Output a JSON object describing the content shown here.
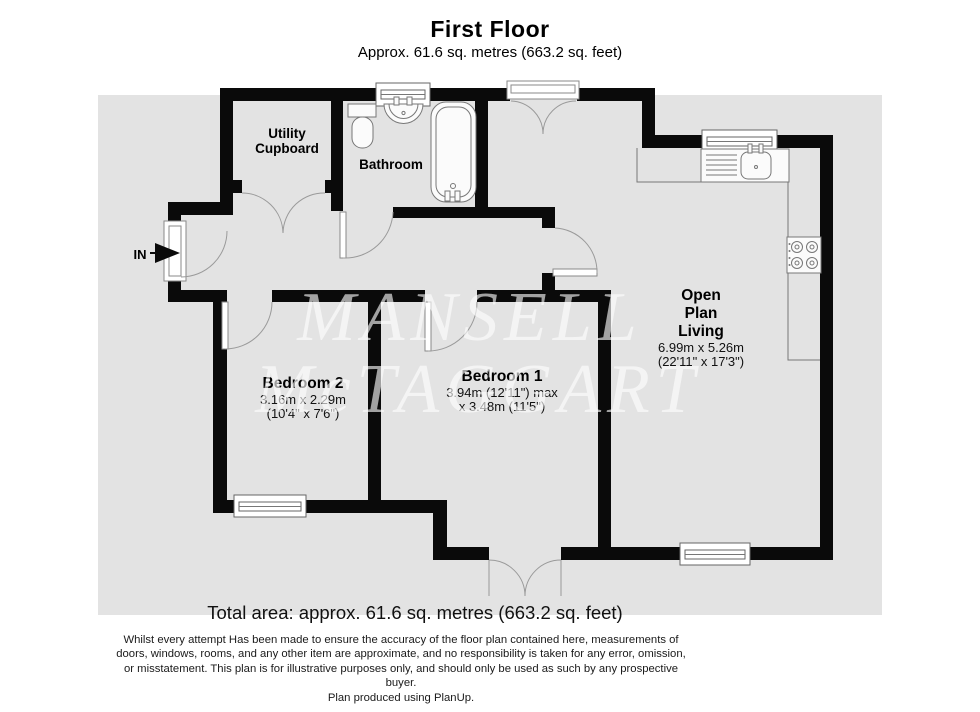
{
  "header": {
    "title": "First Floor",
    "subtitle": "Approx. 61.6 sq. metres (663.2 sq. feet)"
  },
  "rooms": {
    "utility": {
      "name_line1": "Utility",
      "name_line2": "Cupboard"
    },
    "bathroom": {
      "name": "Bathroom"
    },
    "bedroom2": {
      "name": "Bedroom 2",
      "dims_metric": "3.16m x 2.29m",
      "dims_imperial": "(10'4\" x 7'6\")"
    },
    "bedroom1": {
      "name": "Bedroom 1",
      "dims_line1": "3.94m (12'11\") max",
      "dims_line2": "x 3.48m (11'5\")"
    },
    "open_plan_living": {
      "name_line1": "Open",
      "name_line2": "Plan",
      "name_line3": "Living",
      "dims_metric": "6.99m x 5.26m",
      "dims_imperial": "(22'11\" x 17'3\")"
    }
  },
  "entrance": {
    "label": "IN"
  },
  "watermark": {
    "line1": "MANSELL",
    "line2": "McTAGGART"
  },
  "footer": {
    "total_area": "Total area: approx. 61.6 sq. metres (663.2 sq. feet)",
    "disclaimer_line1": "Whilst every attempt Has been made to ensure the accuracy of the floor plan contained here, measurements of",
    "disclaimer_line2": "doors, windows, rooms, and any other item are approximate, and no responsibility is taken for any error, omission,",
    "disclaimer_line3": "or misstatement. This plan is for illustrative purposes only, and should only be used as such by any prospective",
    "disclaimer_line4": "buyer.",
    "credit": "Plan produced using PlanUp."
  },
  "colors": {
    "wall": "#0a0a0a",
    "floor": "#e3e3e3",
    "page": "#ffffff",
    "watermark": "#ffffff"
  }
}
